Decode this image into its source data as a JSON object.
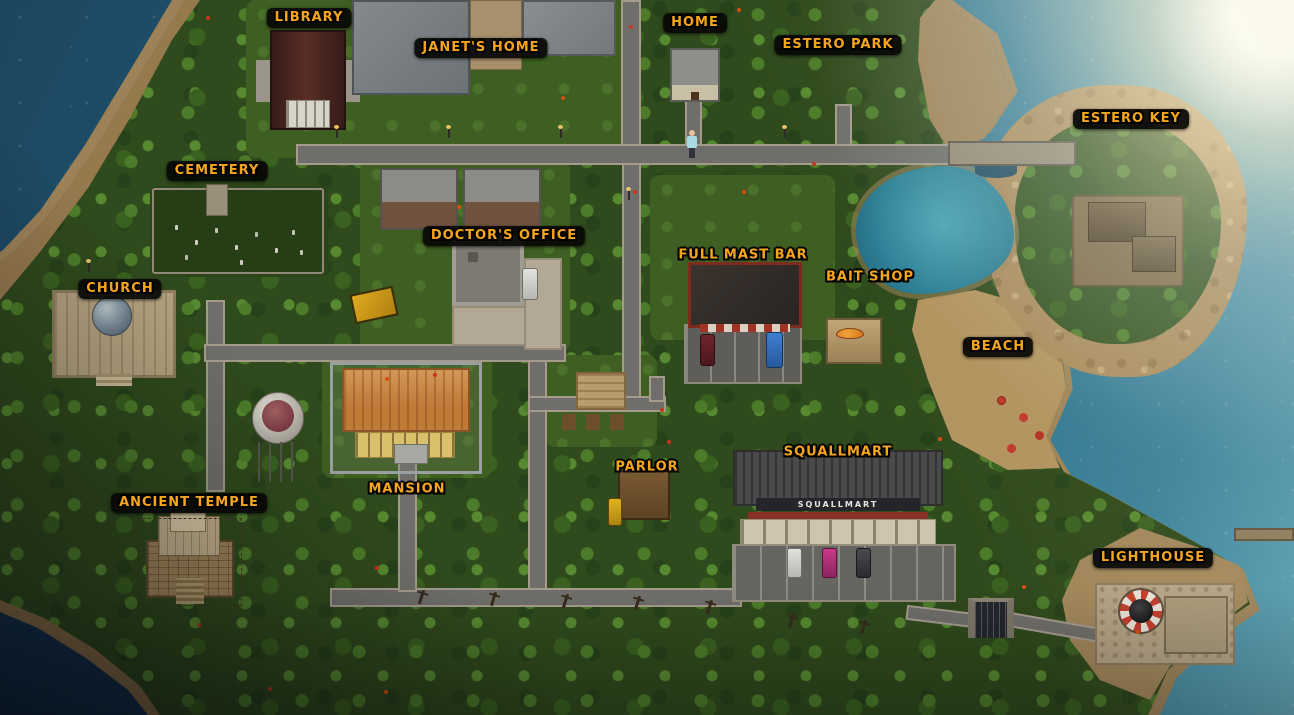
{
  "map_labels": [
    {
      "id": "library",
      "text": "Library"
    },
    {
      "id": "janets-home",
      "text": "Janet's Home"
    },
    {
      "id": "home",
      "text": "Home"
    },
    {
      "id": "estero-park",
      "text": "Estero Park"
    },
    {
      "id": "estero-key",
      "text": "Estero Key"
    },
    {
      "id": "cemetery",
      "text": "Cemetery"
    },
    {
      "id": "doctors-office",
      "text": "Doctor's Office"
    },
    {
      "id": "full-mast-bar",
      "text": "Full Mast Bar"
    },
    {
      "id": "bait-shop",
      "text": "Bait Shop"
    },
    {
      "id": "church",
      "text": "Church"
    },
    {
      "id": "beach",
      "text": "Beach"
    },
    {
      "id": "squallmart",
      "text": "Squallmart"
    },
    {
      "id": "parlor",
      "text": "Parlor"
    },
    {
      "id": "mansion",
      "text": "Mansion"
    },
    {
      "id": "ancient-temple",
      "text": "Ancient Temple"
    },
    {
      "id": "lighthouse",
      "text": "Lighthouse"
    }
  ],
  "signs": {
    "squallmart_storefront": "SQUALLMART"
  },
  "colors": {
    "label_gold": "#f7a61b",
    "label_chip": "#080705",
    "ocean": "#236078",
    "jungle": "#2f4a1c",
    "sand": "#9d8257",
    "road": "#6f6e6a",
    "storefront_sign_text": "#e8e6e2"
  }
}
